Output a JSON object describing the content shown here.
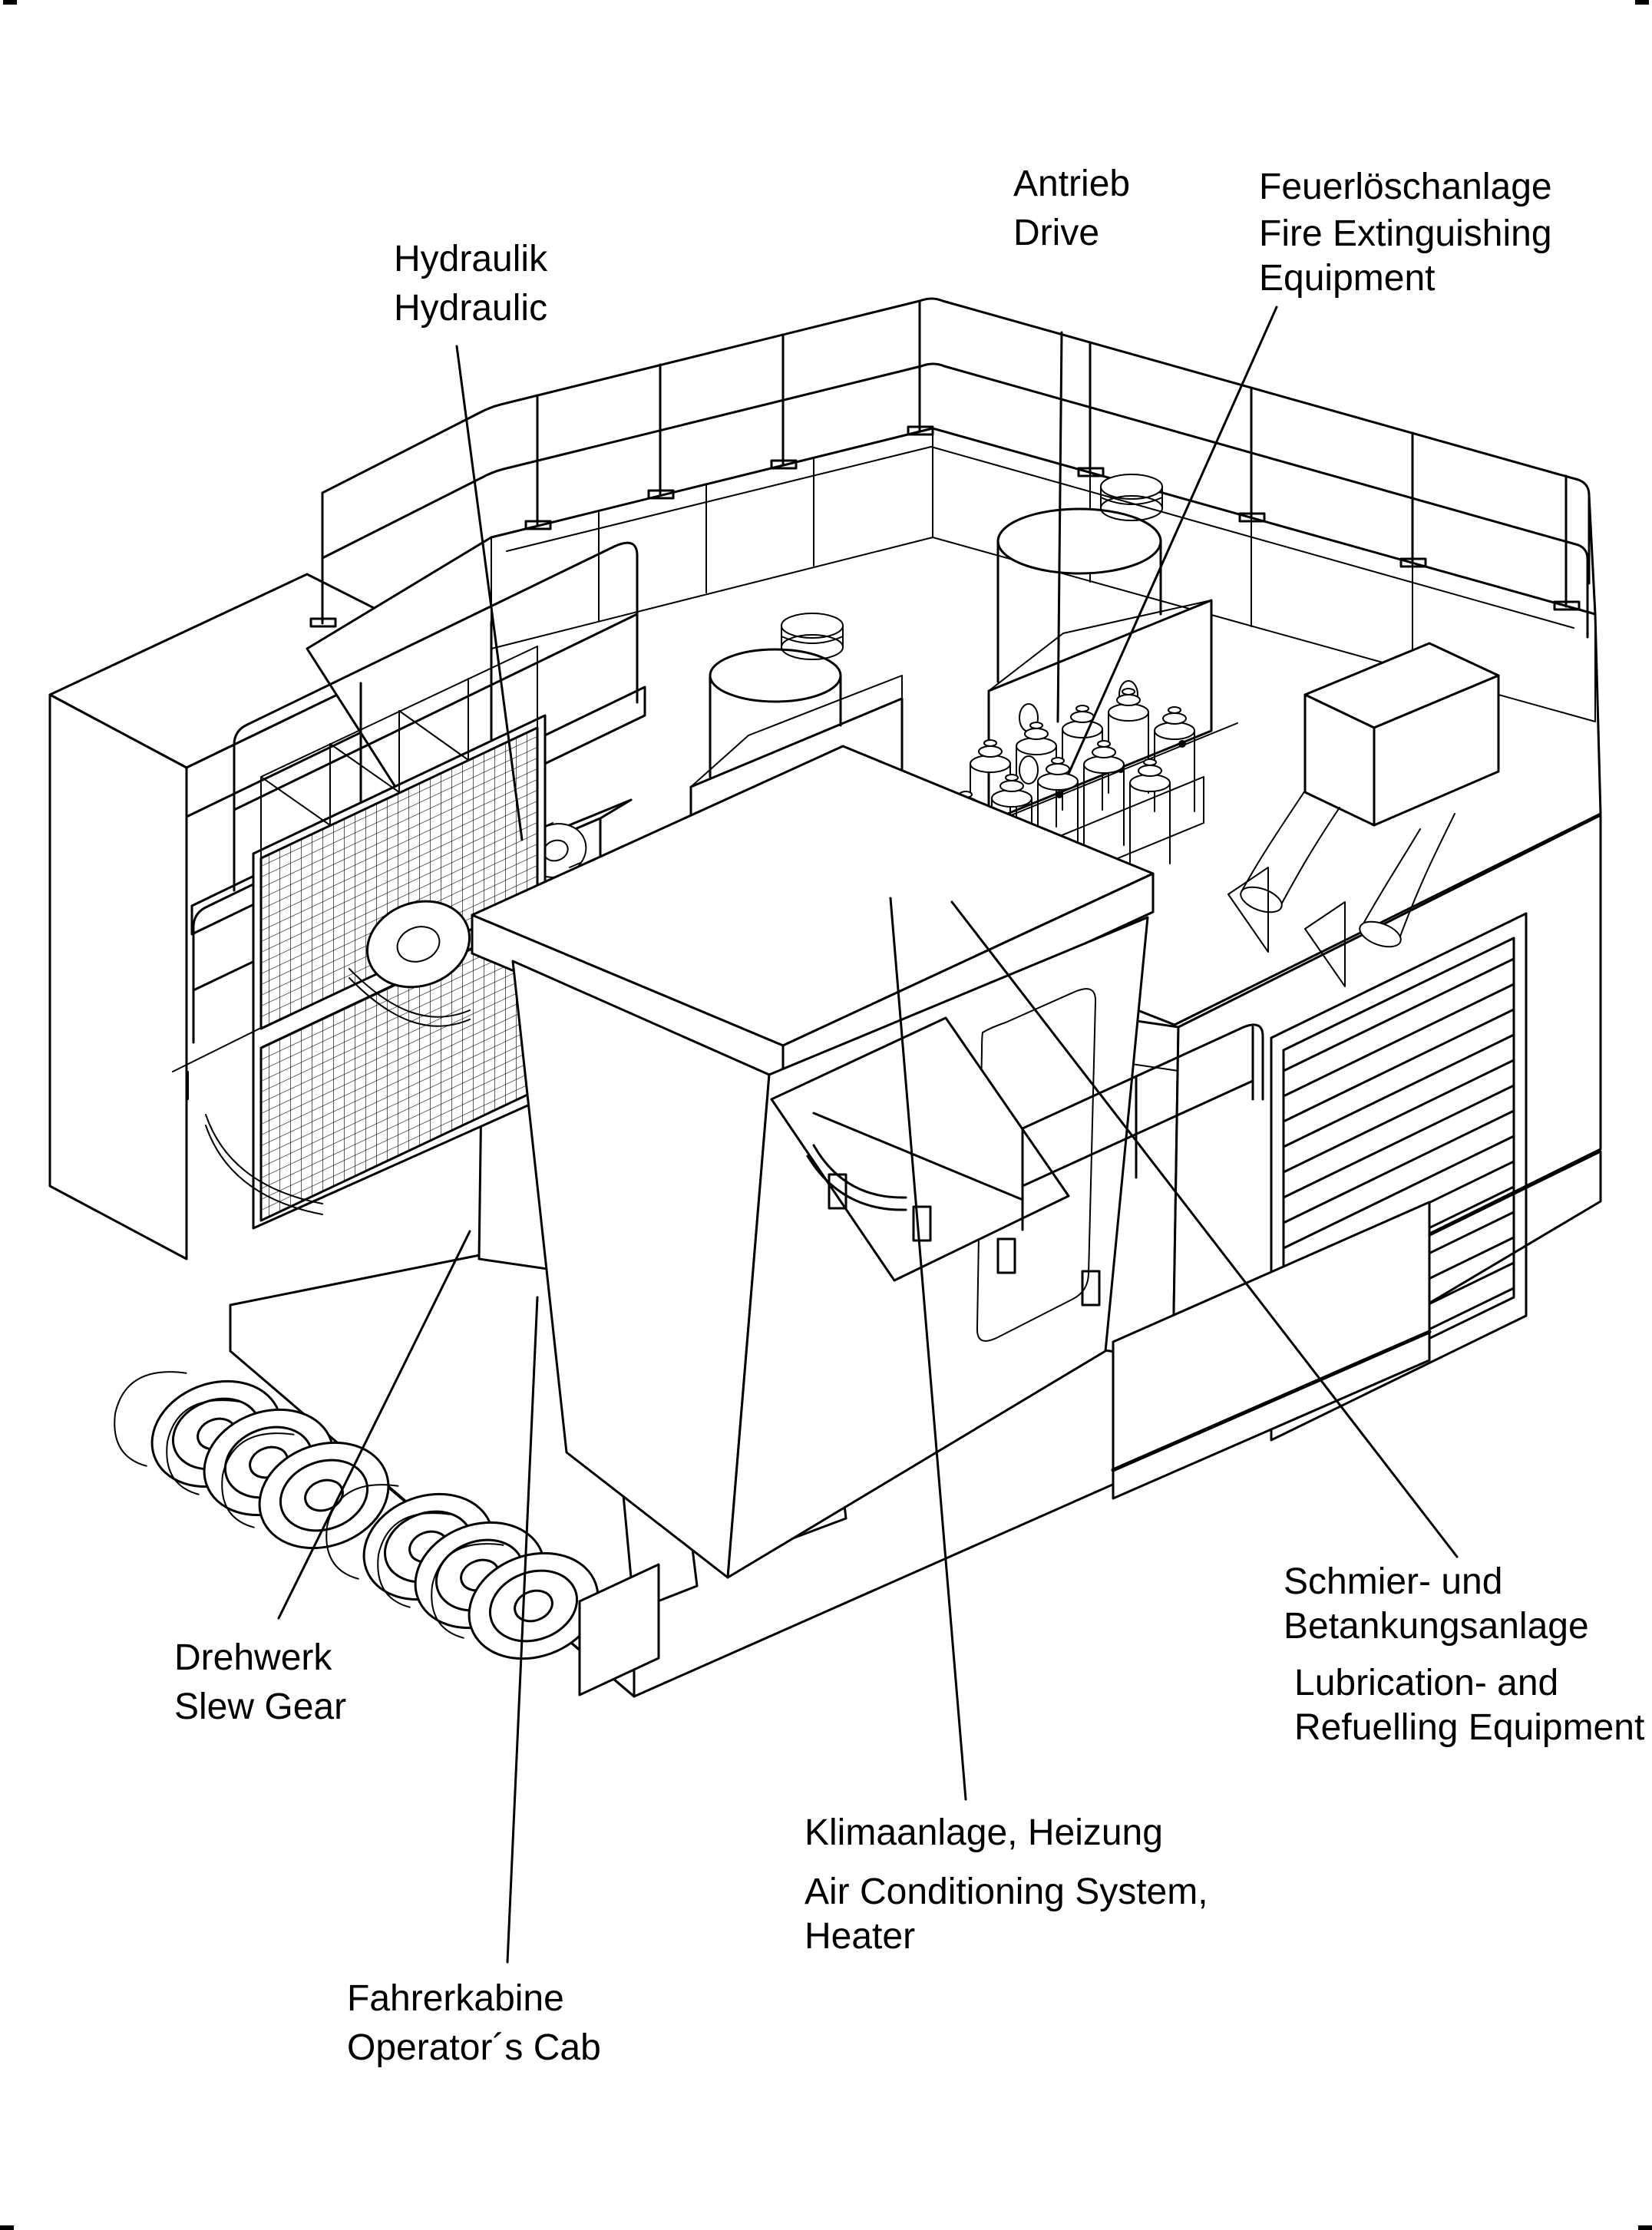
{
  "figure": {
    "kind": "isometric technical illustration of machinery house",
    "line_color": "#000000",
    "background_color": "#ffffff"
  },
  "labels": {
    "hydraulik": {
      "de": "Hydraulik",
      "en": "Hydraulic"
    },
    "antrieb": {
      "de": "Antrieb",
      "en": "Drive"
    },
    "feuerloeschanlage": {
      "de": "Feuerlöschanlage",
      "en1": "Fire Extinguishing",
      "en2": "Equipment"
    },
    "drehwerk": {
      "de": "Drehwerk",
      "en": "Slew Gear"
    },
    "fahrerkabine": {
      "de": "Fahrerkabine",
      "en": "Operator´s Cab"
    },
    "klimaanlage": {
      "de": "Klimaanlage, Heizung",
      "en1": "Air Conditioning System,",
      "en2": "Heater"
    },
    "schmier": {
      "de1": "Schmier- und",
      "de2": "Betankungsanlage",
      "en1": "Lubrication- and",
      "en2": "Refuelling Equipment"
    }
  }
}
